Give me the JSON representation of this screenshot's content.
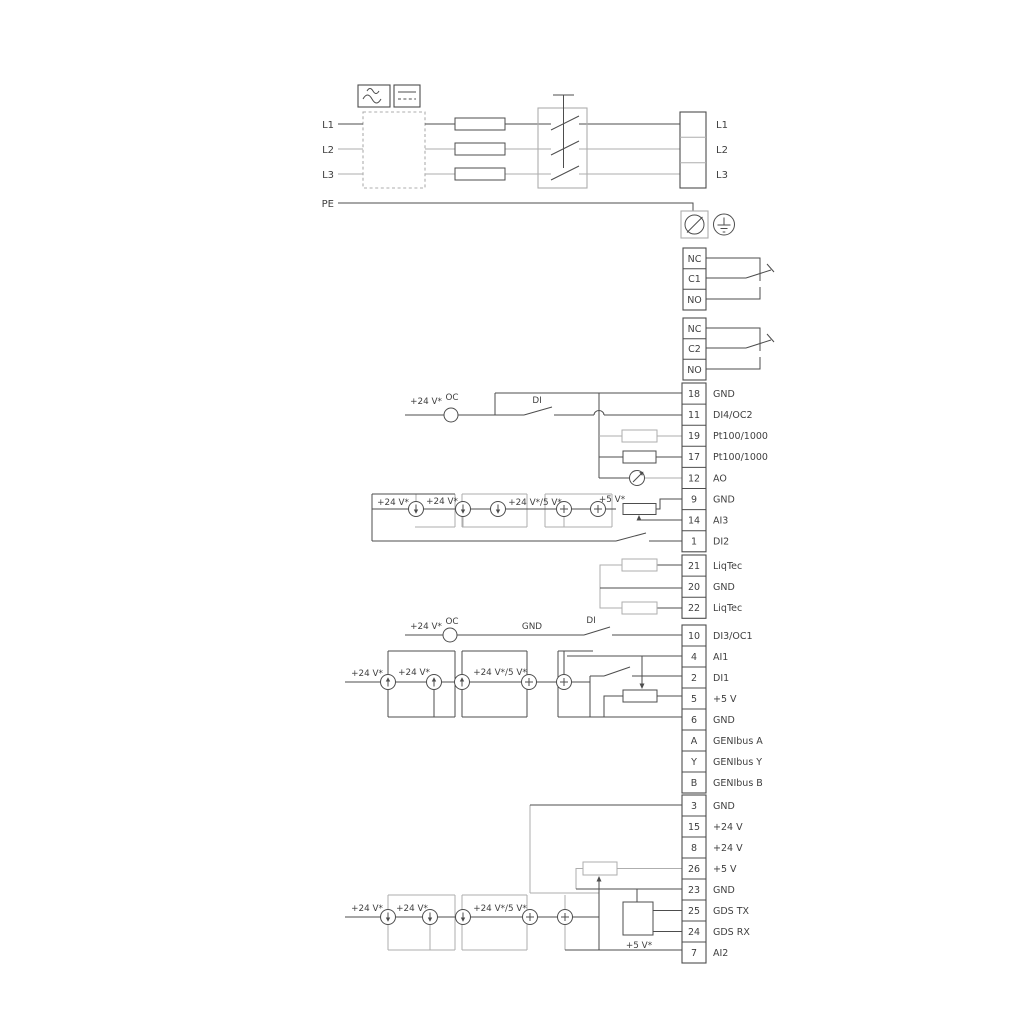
{
  "colors": {
    "line_dark": "#4d4d4d",
    "line_gray": "#aeaeae",
    "text": "#3f3f3f",
    "background": "#ffffff"
  },
  "power_input": {
    "l1": "L1",
    "l2": "L2",
    "l3": "L3",
    "pe": "PE"
  },
  "power_output": {
    "l1": "L1",
    "l2": "L2",
    "l3": "L3"
  },
  "relay1": {
    "nc": "NC",
    "c": "C1",
    "no": "NO"
  },
  "relay2": {
    "nc": "NC",
    "c": "C2",
    "no": "NO"
  },
  "labels": {
    "v24": "+24 V*",
    "v24_5": "+24 V*/5 V*",
    "v5": "+5 V*",
    "oc": "OC",
    "di": "DI",
    "gnd": "GND"
  },
  "strip1": {
    "rows": [
      {
        "n": "18",
        "t": "GND"
      },
      {
        "n": "11",
        "t": "DI4/OC2"
      },
      {
        "n": "19",
        "t": "Pt100/1000"
      },
      {
        "n": "17",
        "t": "Pt100/1000"
      },
      {
        "n": "12",
        "t": "AO"
      },
      {
        "n": "9",
        "t": "GND"
      },
      {
        "n": "14",
        "t": "AI3"
      },
      {
        "n": "1",
        "t": "DI2"
      }
    ]
  },
  "strip2": {
    "rows": [
      {
        "n": "21",
        "t": "LiqTec"
      },
      {
        "n": "20",
        "t": "GND"
      },
      {
        "n": "22",
        "t": "LiqTec"
      }
    ]
  },
  "strip3": {
    "rows": [
      {
        "n": "10",
        "t": "DI3/OC1"
      },
      {
        "n": "4",
        "t": "AI1"
      },
      {
        "n": "2",
        "t": "DI1"
      },
      {
        "n": "5",
        "t": "+5 V"
      },
      {
        "n": "6",
        "t": "GND"
      },
      {
        "n": "A",
        "t": "GENIbus A"
      },
      {
        "n": "Y",
        "t": "GENIbus Y"
      },
      {
        "n": "B",
        "t": "GENIbus B"
      }
    ]
  },
  "strip4": {
    "rows": [
      {
        "n": "3",
        "t": "GND"
      },
      {
        "n": "15",
        "t": "+24 V"
      },
      {
        "n": "8",
        "t": "+24 V"
      },
      {
        "n": "26",
        "t": "+5 V"
      },
      {
        "n": "23",
        "t": "GND"
      },
      {
        "n": "25",
        "t": "GDS TX"
      },
      {
        "n": "24",
        "t": "GDS RX"
      },
      {
        "n": "7",
        "t": "AI2"
      }
    ]
  }
}
